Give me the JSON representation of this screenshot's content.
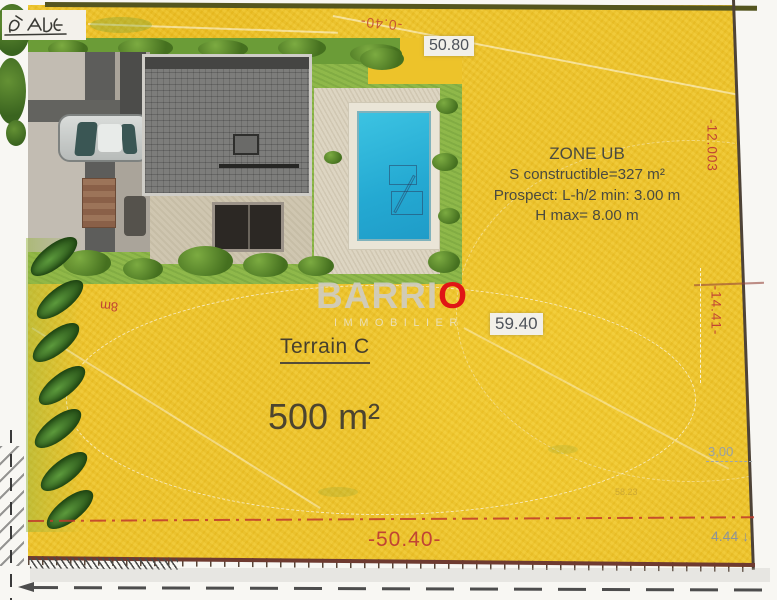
{
  "plan": {
    "measurements": {
      "top_width": "50.80",
      "top_offset": "-0.40-",
      "mid_width": "59.40",
      "bottom_width": "-50.40-",
      "bottom_right_offset": "4.44 ↓",
      "right_depth": "-12.003",
      "right_mid": "-14.41-",
      "right_setback": "3,00",
      "faint_ref": "58.23",
      "left_mark": "8m"
    },
    "zone": {
      "title": "ZONE UB",
      "constructible": "S constructible=327 m²",
      "prospect": "Prospect: L-h/2 min: 3.00 m",
      "height_max": "H max= 8.00 m"
    },
    "terrain": {
      "name": "Terrain C",
      "area": "500 m²"
    },
    "watermark": {
      "brand_prefix": "BARRI",
      "brand_suffix": "O",
      "subtitle": "IMMOBILIER"
    },
    "colors": {
      "terrain_yellow": "#edc32a",
      "measure_red": "#c0392b",
      "boundary_brown": "#6e3a30",
      "pool_blue": "#2ab5d9",
      "grass_green": "#8ab548",
      "brand_red": "#e01515"
    }
  }
}
